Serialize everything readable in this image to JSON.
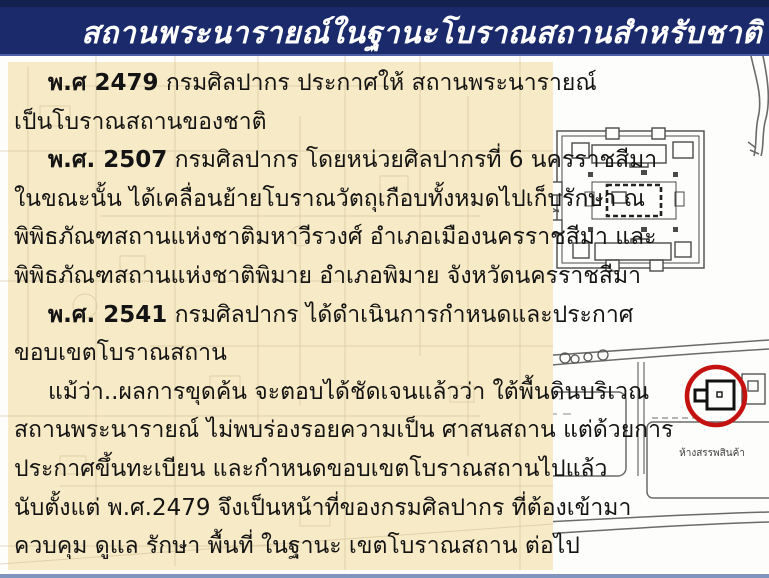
{
  "header": {
    "title": "สถานพระนารายณ์ในฐานะโบราณสถานสำหรับชาติ"
  },
  "body": {
    "lines": [
      {
        "bold": "พ.ศ 2479",
        "text": " กรมศิลปากร ประกาศให้ สถานพระนารายณ์"
      },
      {
        "bold": "",
        "text": "เป็นโบราณสถานของชาติ"
      },
      {
        "bold": "พ.ศ. 2507",
        "text": " กรมศิลปากร โดยหน่วยศิลปากรที่ 6 นครราชสีมา"
      },
      {
        "bold": "",
        "text": "ในขณะนั้น ได้เคลื่อนย้ายโบราณวัตถุเกือบทั้งหมดไปเก็บรักษา ณ"
      },
      {
        "bold": "",
        "text": "พิพิธภัณฑสถานแห่งชาติมหาวีรวงศ์ อำเภอเมืองนครราชสีมา และ"
      },
      {
        "bold": "",
        "text": "พิพิธภัณฑสถานแห่งชาติพิมาย อำเภอพิมาย จังหวัดนครราชสีมา"
      },
      {
        "bold": "พ.ศ. 2541",
        "text": " กรมศิลปากร ได้ดำเนินการกำหนดและประกาศ"
      },
      {
        "bold": "",
        "text": "ขอบเขตโบราณสถาน"
      },
      {
        "bold": "",
        "text": "แม้ว่า..ผลการขุดค้น จะตอบได้ชัดเจนแล้วว่า ใต้พื้นดินบริเวณ"
      },
      {
        "bold": "",
        "text": "สถานพระนารายณ์ ไม่พบร่องรอยความเป็น ศาสนสถาน แต่ด้วยการ"
      },
      {
        "bold": "",
        "text": "ประกาศขึ้นทะเบียน และกำหนดขอบเขตโบราณสถานไปแล้ว"
      },
      {
        "bold": "",
        "text": "นับตั้งแต่ พ.ศ.2479 จึงเป็นหน้าที่ของกรมศิลปากร ที่ต้องเข้ามา"
      },
      {
        "bold": "",
        "text": "ควบคุม ดูแล รักษา พื้นที่ ในฐานะ เขตโบราณสถาน ต่อไป"
      }
    ]
  },
  "map": {
    "department_store_label": "ห้างสรรพสินค้า"
  },
  "colors": {
    "header_bg": "#1b2a6b",
    "header_top_strip": "#13214f",
    "header_bottom_edge": "#4c5fa5",
    "panel_bg": "#f7eac6",
    "body_text": "#141414",
    "red_annotation": "#c41210",
    "bottom_bar": "#8095bd",
    "map_line": "#555555",
    "faint_map_line": "#cdbc92"
  }
}
